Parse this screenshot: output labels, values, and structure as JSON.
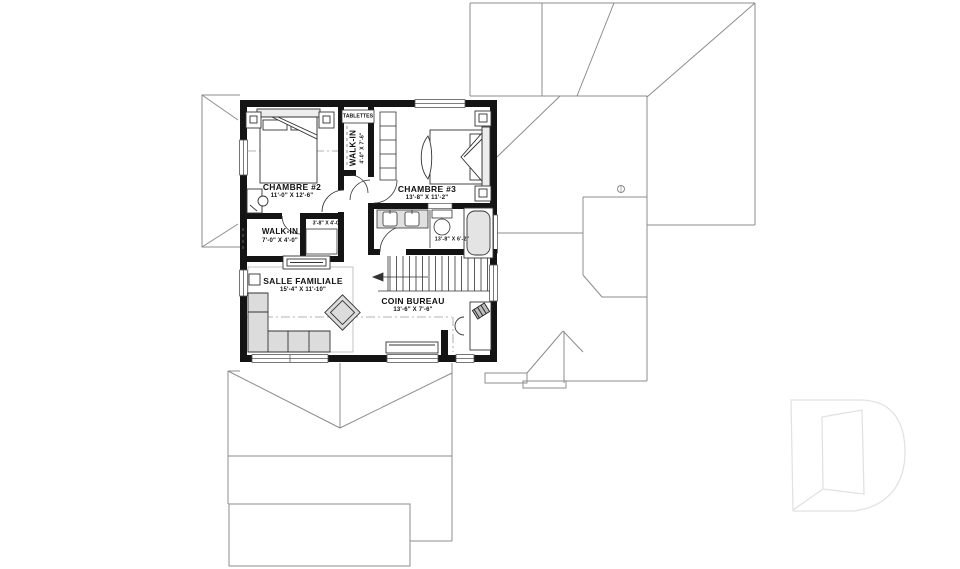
{
  "drawing_type": "floor-plan",
  "language": "french",
  "rooms": {
    "chambre2": {
      "name": "CHAMBRE #2",
      "dims": "11'-0\" X 12'-6\""
    },
    "walkin2": {
      "name": "WALK-IN",
      "dims": "7'-0\" X 4'-0\""
    },
    "closet": {
      "dims": "3'-8\" X 4'-0\""
    },
    "tablettes": {
      "name": "TABLETTES"
    },
    "walkin3": {
      "name": "WALK-IN",
      "dims": "4'-0\" X 7'-6\""
    },
    "chambre3": {
      "name": "CHAMBRE #3",
      "dims": "13'-8\" X 11'-2\""
    },
    "bathroom": {
      "dims": "13'-8\" X 6'-2\""
    },
    "salle_familiale": {
      "name": "SALLE FAMILIALE",
      "dims": "15'-4\" X 11'-10\""
    },
    "coin_bureau": {
      "name": "COIN BUREAU",
      "dims": "13'-6\" X 7'-6\""
    }
  },
  "colors": {
    "wall": "#141414",
    "line": "#333333",
    "roof_line": "#8c8c8c",
    "furniture_fill": "#dcdcdc",
    "watermark": "#e2e2e2",
    "text": "#111111"
  },
  "icons": {
    "watermark": "d-logo-watermark",
    "stairs_arrow": "down-direction-arrow"
  }
}
